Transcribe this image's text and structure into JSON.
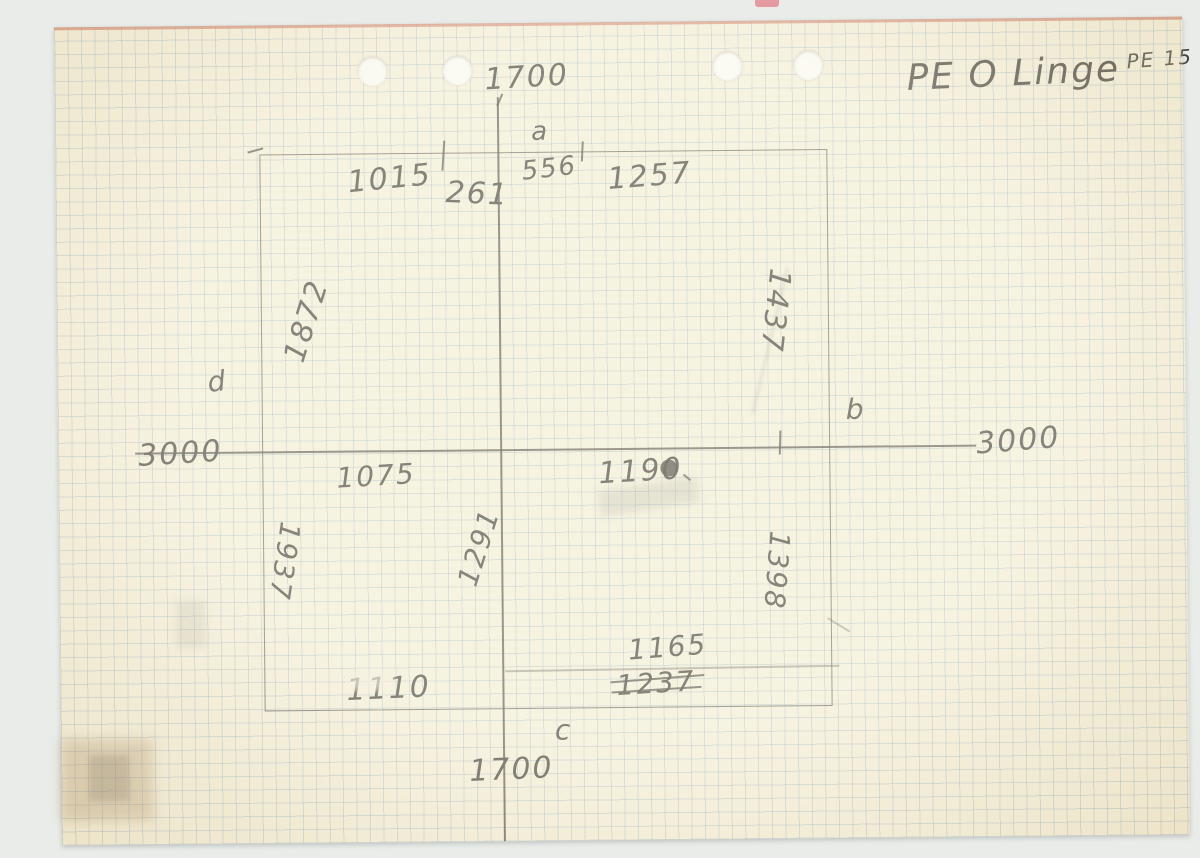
{
  "document": {
    "header": {
      "title": "PE O Linge",
      "reference": "PE 15"
    },
    "axis_labels": {
      "top": "a",
      "right": "b",
      "bottom": "c",
      "left": "d"
    },
    "measurements": {
      "vertical_axis_top": "1700",
      "vertical_axis_bottom": "1700",
      "horizontal_axis_left": "3000",
      "horizontal_axis_right": "3000",
      "top_edge_left": "1015",
      "top_edge_tick": "261",
      "top_edge_center": "556",
      "top_edge_right": "1257",
      "left_wall_upper": "1872",
      "left_wall_lower": "1937",
      "right_wall_upper": "1437",
      "right_wall_lower": "1398",
      "interior_left": "1075",
      "interior_right": "1190",
      "interior_center_lower": "1291",
      "bottom_interior": "1165",
      "bottom_interior_struck": "1237",
      "bottom_edge_left": "1110"
    },
    "colors": {
      "paper": "#f3eeda",
      "grid": "#92acbf",
      "pencil": "#47443d",
      "red_edge": "#cf7f6a"
    }
  }
}
